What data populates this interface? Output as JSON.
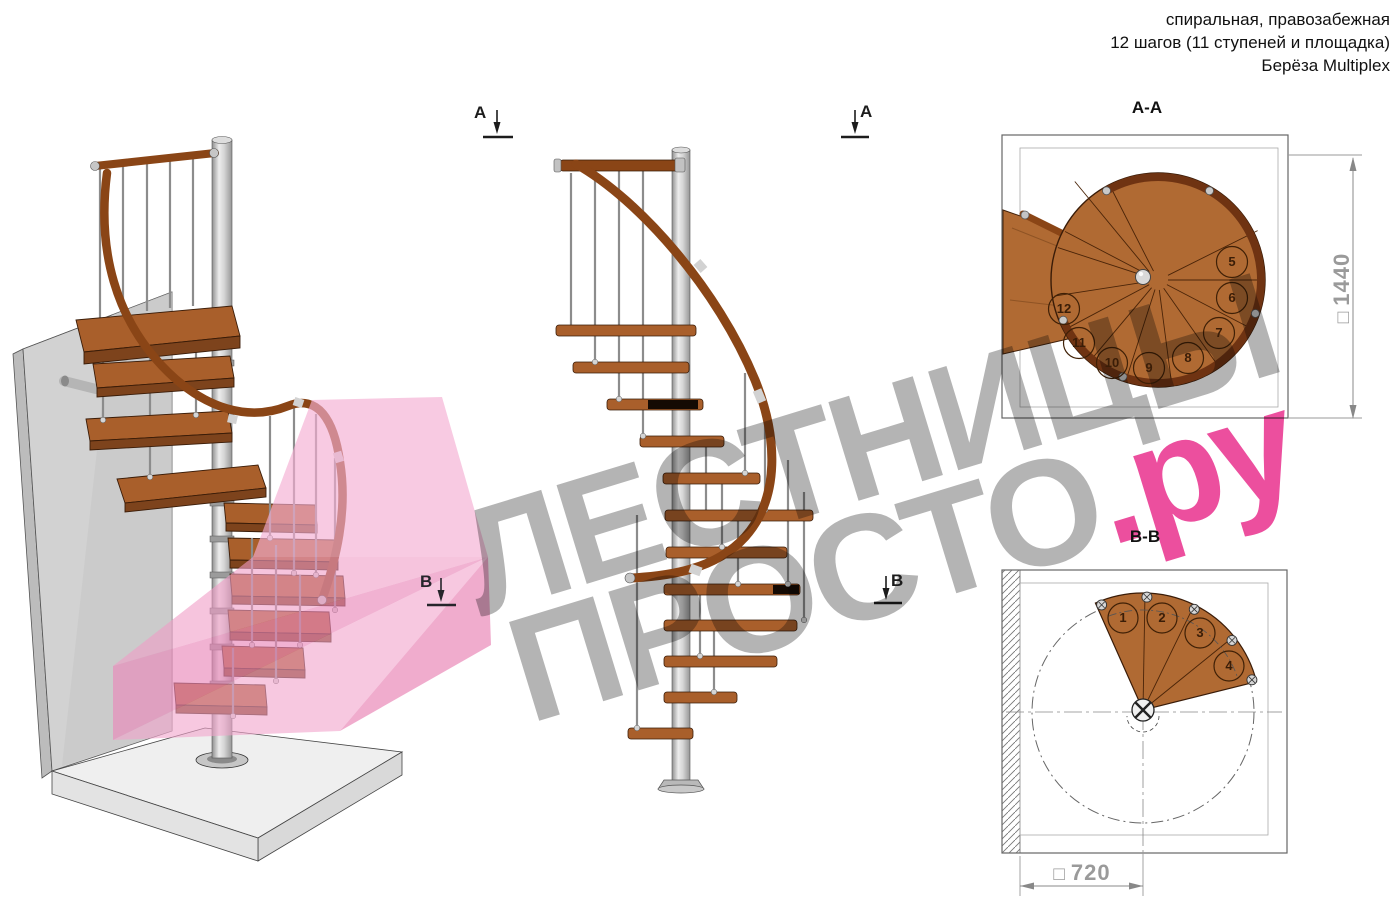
{
  "header": {
    "line1": "спиральная, правозабежная",
    "line2": "12 шагов (11 ступеней и площадка)",
    "line3": "Берёза Multiplex"
  },
  "watermark": {
    "line1": "ЛЕСТНИЦЫ",
    "line2_gray": "ПРОСТО",
    "line2_pink": ".ру",
    "gray_color": "#b4b4b4",
    "pink_color": "#ec4f9e"
  },
  "sections": {
    "aa": {
      "label": "А-А",
      "dim_symbol": "□",
      "dimension": "1440",
      "steps": [
        "5",
        "6",
        "7",
        "8",
        "9",
        "10",
        "11",
        "12"
      ]
    },
    "bb": {
      "label": "В-В",
      "dim_symbol": "□",
      "dimension": "720",
      "steps": [
        "1",
        "2",
        "3",
        "4"
      ]
    }
  },
  "markers": {
    "a": "А",
    "b": "В"
  },
  "colors": {
    "wood": "#b06a33",
    "wood_dark_rail": "#6f3312",
    "metal": "#c9c9c9",
    "overlay_pink": "#f2a0ca",
    "dimension_gray": "#9a9a9a"
  }
}
